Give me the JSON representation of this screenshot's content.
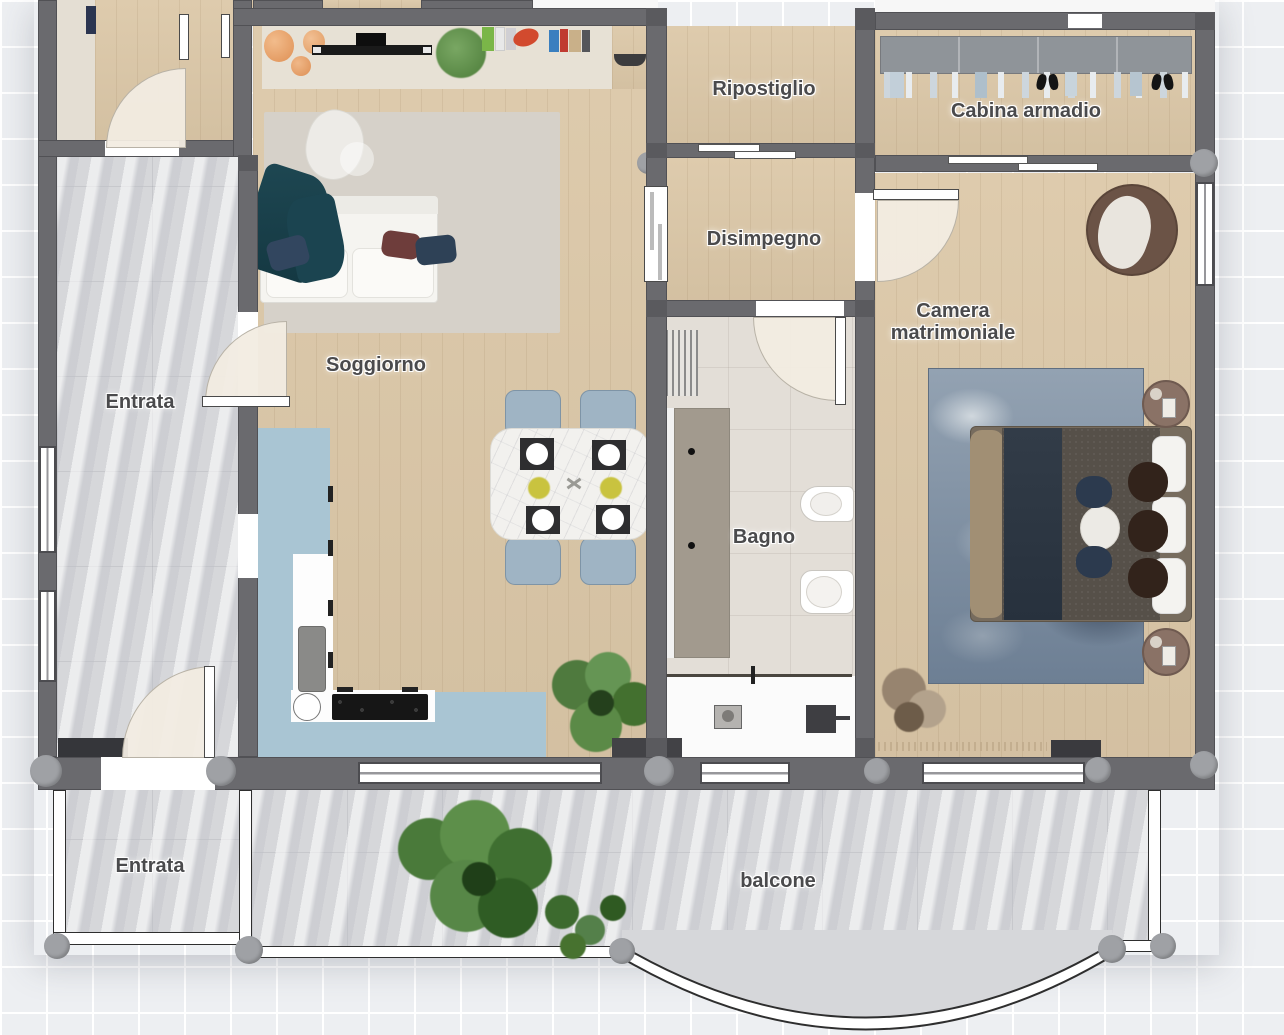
{
  "floorplan": {
    "type": "apartment-floor-plan",
    "rooms": {
      "ripostiglio": {
        "label": "Ripostiglio"
      },
      "cabina_armadio": {
        "label": "Cabina armadio"
      },
      "disimpegno": {
        "label": "Disimpegno"
      },
      "camera": {
        "label": "Camera matrimoniale"
      },
      "soggiorno": {
        "label": "Soggiorno"
      },
      "entrata": {
        "label": "Entrata"
      },
      "bagno": {
        "label": "Bagno"
      },
      "entrata_balcone": {
        "label": "Entrata"
      },
      "balcone": {
        "label": "balcone"
      }
    },
    "colors": {
      "background": "#edeff2",
      "grid_line": "#ffffff",
      "wall": "#6a6a6e",
      "wood_floor": "#dcc8a8",
      "marble_floor": "#d6d7da",
      "bagno_tile": "#e3ded7",
      "kitchen_floor": "#a9c5d3",
      "door_arc": "#f2ece1",
      "label_text": "#4a4a4c",
      "sofa": "#f5f4f0",
      "throw_blanket": "#1d4752",
      "dining_chair": "#9fb4c4",
      "bed_rug_blue": "#8494a7",
      "nightstand_brown": "#8a7266",
      "plant_green": "#5d8f4a"
    },
    "furniture": {
      "soggiorno": [
        "sideboard",
        "tv",
        "decor-plant",
        "books",
        "area-rug",
        "sofa",
        "throw-blanket",
        "pillows",
        "dining-table",
        "dining-chairs",
        "plates",
        "floor-plant",
        "doormat"
      ],
      "kitchen": [
        "counter",
        "sink",
        "cooktop",
        "round-sink",
        "cabinets"
      ],
      "bagno": [
        "towel-rack",
        "vanity",
        "bidet",
        "toilet",
        "washing-machine",
        "laundry-equipment"
      ],
      "camera": [
        "armchair",
        "area-rug",
        "double-bed",
        "pillows",
        "nightstands",
        "dried-plant",
        "doormat"
      ],
      "cabina_armadio": [
        "wardrobe-rail",
        "hanging-clothes",
        "shoes"
      ],
      "balcone": [
        "palm-plants",
        "railing"
      ]
    }
  }
}
